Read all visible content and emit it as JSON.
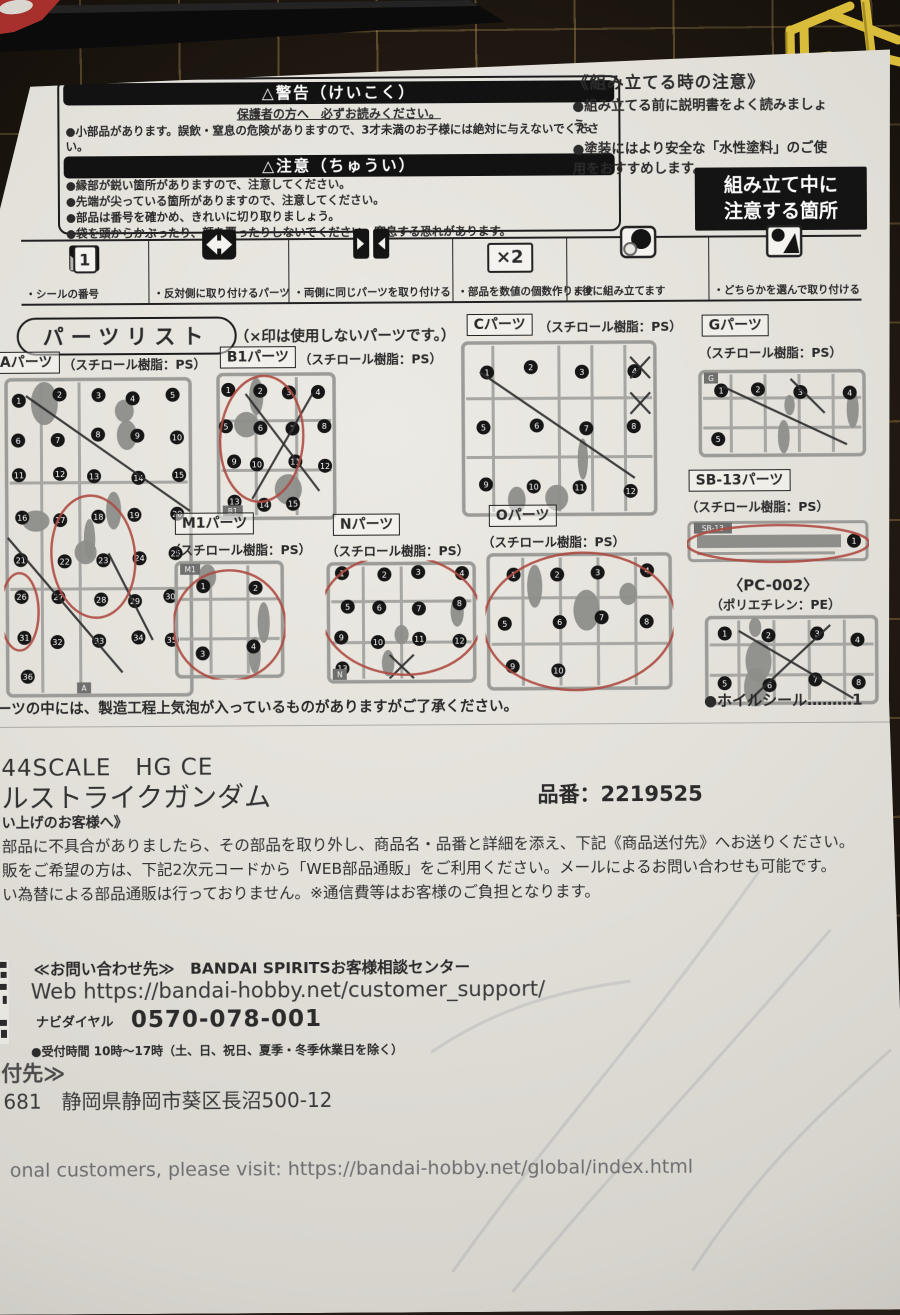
{
  "photo": {
    "mat_color": "#241c14",
    "paper_color": "#e6e3dd",
    "mark_red": "#ad4a41",
    "runner_yellow": "#dcbe3e"
  },
  "safety": {
    "warning_title": "△警告（けいこく）",
    "warning_subtitle": "保護者の方へ　必ずお読みください。",
    "warning_items": [
      "●小部品があります。誤飲・窒息の危険がありますので、3才未満のお子様には絶対に与えないでください。"
    ],
    "caution_title": "△注意（ちゅうい）",
    "caution_items": [
      "●縁部が鋭い箇所がありますので、注意してください。",
      "●先端が尖っている箇所がありますので、注意してください。",
      "●部品は番号を確かめ、きれいに切り取りましょう。",
      "●袋を頭からかぶったり、顔を覆ったりしないでください。窒息する恐れがあります。"
    ]
  },
  "assembly_notes": {
    "title": "《組み立てる時の注意》",
    "items": [
      "●組み立てる前に説明書をよく読みましょう。",
      "●塗装にはより安全な「水性塗料」のご使用をおすすめします。"
    ],
    "badge_line1": "組み立て中に",
    "badge_line2": "注意する箇所"
  },
  "legend": {
    "sample_number": "1",
    "multiply_symbol": "×2",
    "items": [
      {
        "icon": "sticker-number-icon",
        "label": "・シールの番号"
      },
      {
        "icon": "opposite-side-icon",
        "label": "・反対側に取り付けるパーツ"
      },
      {
        "icon": "both-sides-icon",
        "label": "・両側に同じパーツを取り付ける"
      },
      {
        "icon": "multiply-count-icon",
        "label": "・部品を数値の個数作ります"
      },
      {
        "icon": "assemble-later-icon",
        "label": "・後に組み立てます"
      },
      {
        "icon": "choose-one-icon",
        "label": "・どちらかを選んで取り付ける"
      }
    ]
  },
  "parts_list": {
    "title": "パーツリスト",
    "note": "（×印は使用しないパーツです。）",
    "footnote": "ーツの中には、製造工程上気泡が入っているものがありますがご了承ください。",
    "foil_seal": "●ホイルシール………1",
    "parts": [
      {
        "name": "Aパーツ",
        "material": "（スチロール樹脂：PS）",
        "sprue": {
          "pieces": 36,
          "tag": "A",
          "tag_pos": "bc",
          "seed": 7,
          "xs": [
            [
              0.12,
              0.06,
              0.98,
              0.42
            ],
            [
              0.02,
              0.5,
              0.62,
              0.92
            ],
            [
              0.55,
              0.55,
              0.78,
              0.82
            ]
          ],
          "reds": [
            [
              0.47,
              0.56,
              0.22,
              0.19,
              -5
            ],
            [
              0.08,
              0.73,
              0.1,
              0.12,
              0
            ]
          ]
        }
      },
      {
        "name": "B1パーツ",
        "material": "（スチロール樹脂：PS）",
        "sprue": {
          "pieces": 15,
          "tag": "B1",
          "tag_pos": "bl",
          "seed": 11,
          "xs": [
            [
              0.25,
              0.15,
              0.85,
              0.8
            ],
            [
              0.8,
              0.15,
              0.3,
              0.85
            ]
          ],
          "reds": [
            [
              0.38,
              0.45,
              0.34,
              0.42,
              4
            ]
          ]
        }
      },
      {
        "name": "Cパーツ",
        "material": "（スチロール樹脂：PS）",
        "sprue": {
          "pieces": 12,
          "seed": 3,
          "xs": [
            [
              0.1,
              0.18,
              0.88,
              0.78
            ],
            [
              0.86,
              0.1,
              0.96,
              0.22
            ],
            [
              0.96,
              0.1,
              0.86,
              0.22
            ],
            [
              0.86,
              0.3,
              0.96,
              0.42
            ],
            [
              0.96,
              0.3,
              0.86,
              0.42
            ]
          ],
          "reds": []
        }
      },
      {
        "name": "Gパーツ",
        "material": "（スチロール樹脂：PS）",
        "material_below": true,
        "sprue": {
          "pieces": 5,
          "tag": "G",
          "tag_pos": "tl",
          "seed": 5,
          "xs": [
            [
              0.15,
              0.2,
              0.88,
              0.85
            ],
            [
              0.55,
              0.12,
              0.75,
              0.5
            ]
          ],
          "reds": []
        }
      },
      {
        "name": "M1パーツ",
        "material": "（スチロール樹脂：PS）",
        "material_below": true,
        "sprue": {
          "pieces": 4,
          "tag": "M1",
          "tag_pos": "tl",
          "seed": 13,
          "xs": [],
          "reds": [
            [
              0.5,
              0.55,
              0.5,
              0.46,
              0
            ]
          ]
        }
      },
      {
        "name": "Nパーツ",
        "material": "（スチロール樹脂：PS）",
        "material_below": true,
        "sprue": {
          "pieces": 13,
          "tag": "N",
          "tag_pos": "bl",
          "seed": 17,
          "xs": [
            [
              0.42,
              0.76,
              0.58,
              0.95
            ],
            [
              0.58,
              0.76,
              0.42,
              0.95
            ]
          ],
          "reds": [
            [
              0.5,
              0.44,
              0.53,
              0.48,
              5
            ]
          ]
        }
      },
      {
        "name": "Oパーツ",
        "material": "（スチロール樹脂：PS）",
        "material_below": true,
        "sprue": {
          "pieces": 10,
          "seed": 19,
          "xs": [],
          "reds": [
            [
              0.5,
              0.5,
              0.51,
              0.49,
              -3
            ]
          ]
        }
      },
      {
        "name": "SB-13パーツ",
        "material": "（スチロール樹脂：PS）",
        "material_below": true,
        "sprue": {
          "pieces": 1,
          "beam": true,
          "tag": "SB-13",
          "tag_pos": "tl",
          "seed": 23,
          "xs": [],
          "reds": [
            [
              0.5,
              0.55,
              0.5,
              0.4,
              0
            ]
          ]
        }
      },
      {
        "name": "〈PC-002〉",
        "material": "（ポリエチレン：PE）",
        "plain": true,
        "sprue": {
          "pieces": 8,
          "seed": 29,
          "xs": [
            [
              0.2,
              0.18,
              0.85,
              0.92
            ],
            [
              0.72,
              0.12,
              0.25,
              0.95
            ]
          ],
          "reds": []
        }
      }
    ]
  },
  "product": {
    "scale_line": "44SCALE　HG CE",
    "name_line": "ルストライクガンダム",
    "part_number": "品番：2219525",
    "customer_heading": "い上げのお客様へ》",
    "body_lines": [
      "部品に不具合がありましたら、その部品を取り外し、商品名・品番と詳細を添え、下記《商品送付先》へお送りください。",
      "販をご希望の方は、下記2次元コードから「WEB部品通販」をご利用ください。メールによるお問い合わせも可能です。",
      "い為替による部品通販は行っておりません。※通信費等はお客様のご負担となります。"
    ]
  },
  "contact": {
    "heading": "≪お問い合わせ先≫　BANDAI SPIRITSお客様相談センター",
    "web": "Web https://bandai-hobby.net/customer_support/",
    "navi_label": "ナビダイヤル",
    "phone": "0570-078-001",
    "hours": "●受付時間 10時～17時（土、日、祝日、夏季・冬季休業日を除く）"
  },
  "shipping": {
    "heading": "付先≫",
    "address": "681　静岡県静岡市葵区長沼500-12"
  },
  "footer": {
    "global_line": "onal customers, please visit: https://bandai-hobby.net/global/index.html"
  }
}
